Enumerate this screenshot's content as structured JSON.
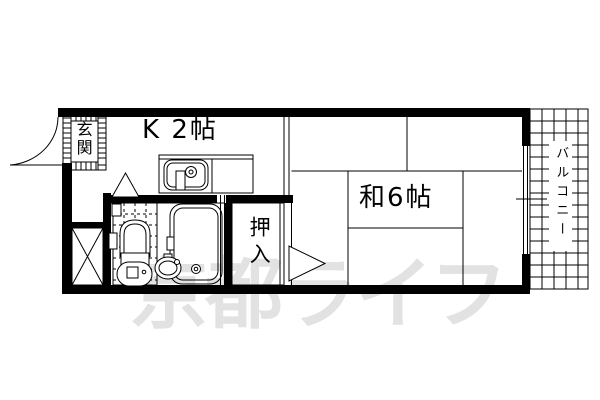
{
  "plan": {
    "type": "apartment-floor-plan",
    "labels": {
      "entrance": "玄関",
      "kitchen": "K 2帖",
      "japanese_room": "和6帖",
      "closet": "押入",
      "balcony": "バルコニー"
    },
    "watermark": {
      "text": "京都ライフ",
      "color": "#e2e2e2"
    },
    "colors": {
      "line": "#000000",
      "background": "#ffffff"
    }
  }
}
